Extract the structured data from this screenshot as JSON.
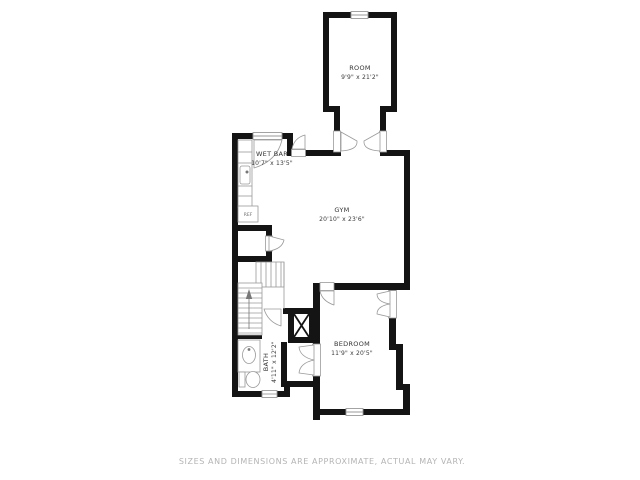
{
  "plan": {
    "rooms": {
      "room": {
        "label": "ROOM",
        "dims": "9'9\" x 21'2\""
      },
      "wet_bar": {
        "label": "WET BAR",
        "dims": "10'7\" x 13'5\""
      },
      "gym": {
        "label": "GYM",
        "dims": "20'10\" x 23'6\""
      },
      "bedroom": {
        "label": "BEDROOM",
        "dims": "11'9\" x 20'5\""
      },
      "bath": {
        "label": "BATH",
        "dims": "4'11\" x 12'2\""
      }
    },
    "fixtures": {
      "refrigerator_label": "REF",
      "icons": [
        "window",
        "door-swing",
        "stairs",
        "stairs-direction-arrow",
        "wet-bar-sink",
        "vanity-sink",
        "toilet",
        "utility-shaft-x"
      ]
    },
    "colors": {
      "wall": "#141414",
      "fixture_line": "#9a9a9a",
      "label_text": "#333333",
      "footer_text": "#b4b4b4",
      "background": "#ffffff"
    }
  },
  "footer": {
    "disclaimer": "SIZES AND DIMENSIONS ARE APPROXIMATE, ACTUAL MAY VARY."
  }
}
